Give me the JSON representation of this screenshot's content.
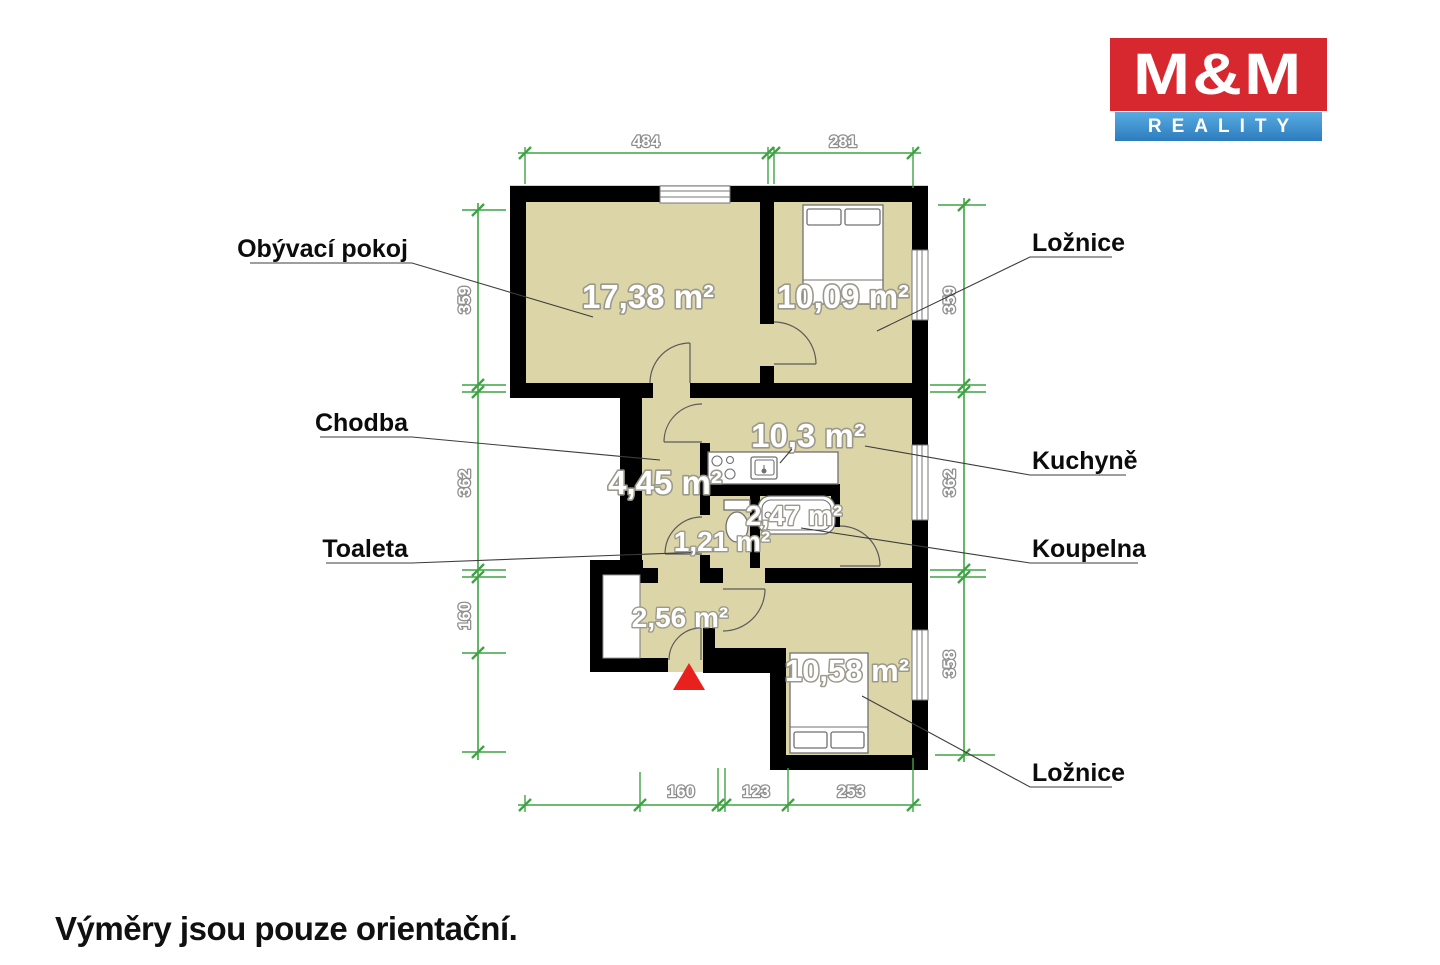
{
  "branding": {
    "logo_line1": "M&M",
    "logo_line2": "REALITY",
    "logo_red": "#d7282f",
    "logo_blue_top": "#58abe1",
    "logo_blue_bottom": "#2d7cbe"
  },
  "disclaimer": "Výměry jsou pouze orientační.",
  "plan": {
    "colors": {
      "floor": "#dcd5a8",
      "wall": "#000000",
      "dimension_green": "#3fa344"
    },
    "rooms": [
      {
        "name": "Obývací pokoj",
        "area": "17,38 m²"
      },
      {
        "name": "Ložnice",
        "area": "10,09 m²"
      },
      {
        "name": "Chodba",
        "area": "4,45 m²"
      },
      {
        "name": "Kuchyně",
        "area": "10,3 m²"
      },
      {
        "name": "Koupelna",
        "area": "2,47 m²"
      },
      {
        "name": "Toaleta",
        "area": "1,21 m²"
      },
      {
        "name": "Ložnice",
        "area": "10,58 m²"
      },
      {
        "name": "",
        "area": "2,56 m²"
      }
    ],
    "dimensions": {
      "top": [
        "484",
        "281"
      ],
      "left": [
        "359",
        "362",
        "160"
      ],
      "right": [
        "359",
        "362",
        "358"
      ],
      "bottom": [
        "160",
        "123",
        "253"
      ]
    }
  }
}
